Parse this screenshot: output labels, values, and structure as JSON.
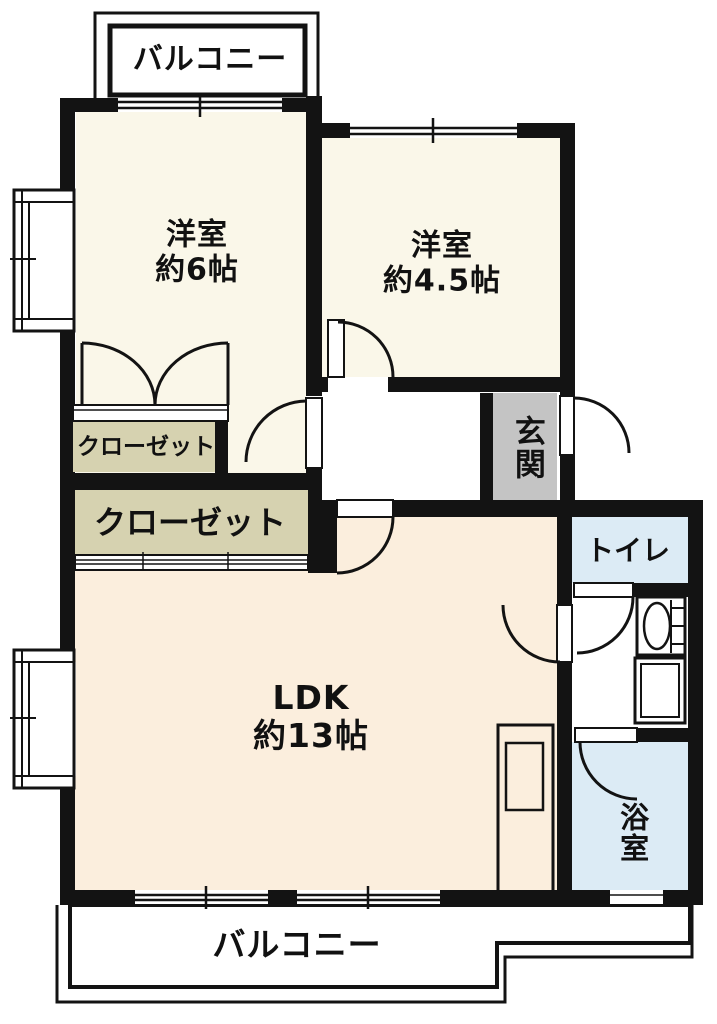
{
  "rooms": [
    {
      "id": "balcony-top",
      "label": "バルコニー"
    },
    {
      "id": "bedroom-1",
      "label": "洋室",
      "size": "約6帖"
    },
    {
      "id": "bedroom-2",
      "label": "洋室",
      "size": "約4.5帖"
    },
    {
      "id": "closet-small",
      "label": "クローゼット"
    },
    {
      "id": "closet-large",
      "label": "クローゼット"
    },
    {
      "id": "entrance",
      "label": "玄関"
    },
    {
      "id": "toilet",
      "label": "トイレ"
    },
    {
      "id": "ldk",
      "label": "LDK",
      "size": "約13帖"
    },
    {
      "id": "bath",
      "label": "浴室"
    },
    {
      "id": "balcony-bottom",
      "label": "バルコニー"
    }
  ],
  "colors": {
    "wall": "#131313",
    "room_cream": "#faf7e9",
    "ldk_peach": "#fbeedd",
    "closet_tan": "#d6d2b0",
    "balcony_gray": "#bdbdbd",
    "entrance_gray": "#c4c4c4",
    "wet_blue": "#dcebf5"
  }
}
